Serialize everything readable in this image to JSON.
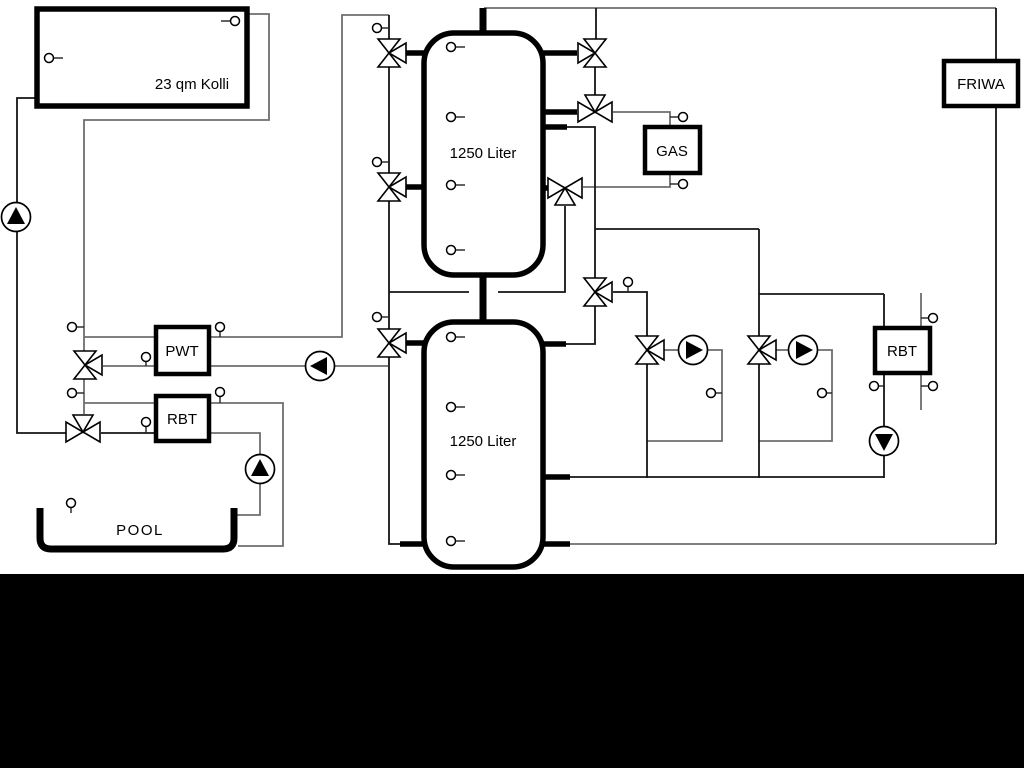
{
  "theme": {
    "bg": "#ffffff",
    "footer": "#000000",
    "pipe_black": "#141414",
    "pipe_gray": "#6e6e6e",
    "component_stroke": "#000000",
    "component_fill": "#ffffff"
  },
  "diagram": {
    "collector_label": "23 qm Kolli",
    "tank_top_label": "1250 Liter",
    "tank_bottom_label": "1250 Liter",
    "gas_label": "GAS",
    "friwa_label": "FRIWA",
    "pwt_label": "PWT",
    "rbt_left_label": "RBT",
    "rbt_right_label": "RBT",
    "pool_label": "POOL"
  }
}
